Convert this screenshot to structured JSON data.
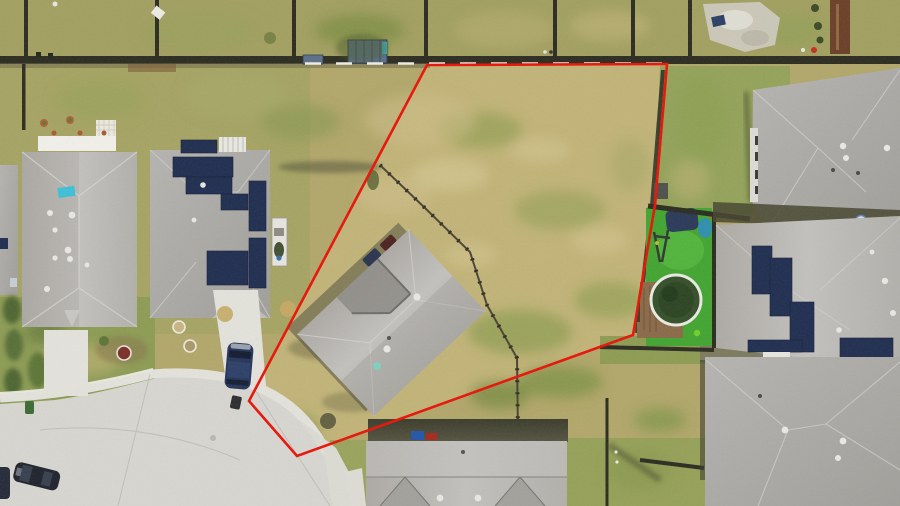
{
  "scene": {
    "type": "aerial-photo",
    "subject": "residential-vacant-lot-with-property-boundary-overlay",
    "canvas": {
      "width": 900,
      "height": 506
    }
  },
  "boundary": {
    "points": "427,65 667,64 655,205 633,335 297,456 249,401",
    "stroke_width": 2.6
  },
  "palette": {
    "boundary_red": "#e81408",
    "grass_top": "#a3a061",
    "grass_base": "#b2a76a",
    "lot_tan": "#c2b478",
    "grass_olive": "#8f9c52",
    "grass_green": "#7e9748",
    "grass_front_left": "#8d9c54",
    "grass_sand": "#d5c792",
    "grass_dark": "#5d6b33",
    "turf_green": "#43a531",
    "pool_water": "#35502a",
    "pool_rim": "#e9eae2",
    "deck_brown": "#8a6b49",
    "roof_light": "#bcbab6",
    "roof_mid": "#a9a7a2",
    "roof_dark": "#8f8d89",
    "roof_valley": "#7b7975",
    "solar_navy": "#202e50",
    "fence_dark": "#2c2c21",
    "fence_brown": "#6b4028",
    "concrete": "#d7d6d0",
    "concrete_light": "#e3e2db",
    "curb_white": "#efede6",
    "vehicle_navy": "#26365c",
    "vehicle_dark": "#20242e",
    "shed_slate": "#5d7089",
    "teal": "#3ab6c6",
    "white": "#f1f0ea"
  }
}
